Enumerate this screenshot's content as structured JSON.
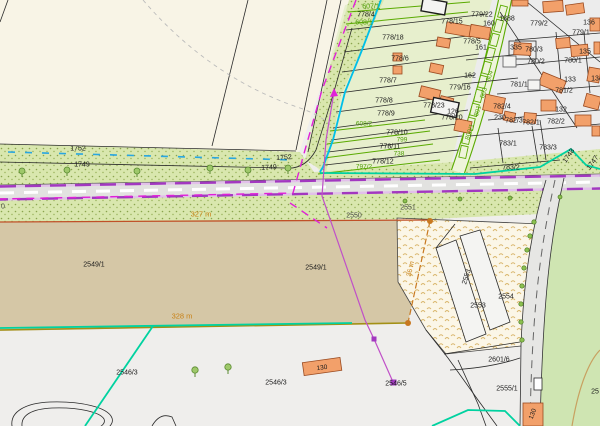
{
  "map": {
    "type": "cadastral-parcel-map",
    "label_colors": {
      "black": "#1b1b1b",
      "green": "#4f9e06",
      "orange": "#c88014",
      "gray": "#4a4a4a"
    },
    "feature_colors": {
      "selection_teal": "#00d2a0",
      "guide_cyan": "#00bfe8",
      "survey_magenta": "#e020d8",
      "road_axis_purple": "#a238c0",
      "dimension_orange": "#c87820",
      "field_tan": "#d5c7a6",
      "building_orange": "#f2a06a",
      "vegetation_green": "#d9e7ae",
      "water_dash_blue": "#2aa6e0"
    },
    "labels": [
      {
        "t": "1752",
        "x": 78,
        "y": 149
      },
      {
        "t": "1752",
        "x": 284,
        "y": 158,
        "r": -3
      },
      {
        "t": "1749",
        "x": 82,
        "y": 165
      },
      {
        "t": "1749",
        "x": 269,
        "y": 168,
        "r": -3
      },
      {
        "t": "607/1",
        "x": 371,
        "y": 7,
        "c": "green"
      },
      {
        "t": "778/4",
        "x": 366,
        "y": 15
      },
      {
        "t": "608/1",
        "x": 364,
        "y": 23,
        "c": "green"
      },
      {
        "t": "778/18",
        "x": 393,
        "y": 38
      },
      {
        "t": "778/6",
        "x": 400,
        "y": 59
      },
      {
        "t": "778/7",
        "x": 388,
        "y": 81
      },
      {
        "t": "778/8",
        "x": 384,
        "y": 101
      },
      {
        "t": "778/9",
        "x": 386,
        "y": 114
      },
      {
        "t": "608/2",
        "x": 364,
        "y": 124,
        "c": "green",
        "s": 6.5
      },
      {
        "t": "778/10",
        "x": 397,
        "y": 133
      },
      {
        "t": "799",
        "x": 402,
        "y": 140,
        "c": "green",
        "s": 6.5
      },
      {
        "t": "778/11",
        "x": 390,
        "y": 147
      },
      {
        "t": "738",
        "x": 399,
        "y": 154,
        "c": "green",
        "s": 6.5
      },
      {
        "t": "778/12",
        "x": 383,
        "y": 162
      },
      {
        "t": "797/2",
        "x": 364,
        "y": 167,
        "c": "green",
        "s": 6.5
      },
      {
        "t": "778/15",
        "x": 452,
        "y": 22
      },
      {
        "t": "779/22",
        "x": 482,
        "y": 15
      },
      {
        "t": "160",
        "x": 489,
        "y": 24
      },
      {
        "t": "1388",
        "x": 507,
        "y": 19
      },
      {
        "t": "779/2",
        "x": 539,
        "y": 24
      },
      {
        "t": "136",
        "x": 589,
        "y": 23
      },
      {
        "t": "779/1",
        "x": 581,
        "y": 33
      },
      {
        "t": "778/5",
        "x": 472,
        "y": 42
      },
      {
        "t": "161",
        "x": 481,
        "y": 48
      },
      {
        "t": "335",
        "x": 516,
        "y": 48
      },
      {
        "t": "780/3",
        "x": 534,
        "y": 50
      },
      {
        "t": "780/2",
        "x": 536,
        "y": 62
      },
      {
        "t": "135",
        "x": 585,
        "y": 52
      },
      {
        "t": "780/1",
        "x": 573,
        "y": 61
      },
      {
        "t": "162",
        "x": 470,
        "y": 76
      },
      {
        "t": "779/16",
        "x": 460,
        "y": 88
      },
      {
        "t": "781/1",
        "x": 519,
        "y": 85
      },
      {
        "t": "133",
        "x": 570,
        "y": 80
      },
      {
        "t": "134",
        "x": 597,
        "y": 79
      },
      {
        "t": "781/2",
        "x": 564,
        "y": 91
      },
      {
        "t": "778/23",
        "x": 434,
        "y": 106
      },
      {
        "t": "126",
        "x": 453,
        "y": 112
      },
      {
        "t": "778/20",
        "x": 452,
        "y": 118
      },
      {
        "t": "782/4",
        "x": 502,
        "y": 107
      },
      {
        "t": "230",
        "x": 500,
        "y": 118
      },
      {
        "t": "782/3",
        "x": 514,
        "y": 121
      },
      {
        "t": "782/1",
        "x": 531,
        "y": 123
      },
      {
        "t": "782/2",
        "x": 556,
        "y": 122
      },
      {
        "t": "132",
        "x": 561,
        "y": 110
      },
      {
        "t": "783/1",
        "x": 508,
        "y": 144
      },
      {
        "t": "783/3",
        "x": 548,
        "y": 148
      },
      {
        "t": "783/2",
        "x": 511,
        "y": 168
      },
      {
        "t": "1748",
        "x": 569,
        "y": 156,
        "r": -55
      },
      {
        "t": "1747",
        "x": 593,
        "y": 163,
        "r": -55
      },
      {
        "t": "804",
        "x": 490,
        "y": 76,
        "c": "green",
        "r": -72,
        "s": 6.5
      },
      {
        "t": "803",
        "x": 484,
        "y": 93,
        "c": "green",
        "r": -72,
        "s": 6.5
      },
      {
        "t": "801",
        "x": 478,
        "y": 111,
        "c": "green",
        "r": -72,
        "s": 6.5
      },
      {
        "t": "800/1",
        "x": 470,
        "y": 132,
        "c": "green",
        "r": -72,
        "s": 6.5
      },
      {
        "t": "2551",
        "x": 408,
        "y": 208,
        "c": "gray"
      },
      {
        "t": "2550",
        "x": 354,
        "y": 216,
        "c": "gray"
      },
      {
        "t": "0",
        "x": 3,
        "y": 207,
        "c": "gray"
      },
      {
        "t": "327 m",
        "x": 201,
        "y": 214,
        "c": "orange",
        "s": 7.5
      },
      {
        "t": "2549/1",
        "x": 94,
        "y": 265
      },
      {
        "t": "2549/1",
        "x": 316,
        "y": 268
      },
      {
        "t": "328 m",
        "x": 182,
        "y": 316,
        "c": "orange",
        "s": 7.5
      },
      {
        "t": "36 m",
        "x": 411,
        "y": 269,
        "c": "orange",
        "r": -78
      },
      {
        "t": "2546/3",
        "x": 127,
        "y": 373
      },
      {
        "t": "2546/3",
        "x": 276,
        "y": 383
      },
      {
        "t": "2546/5",
        "x": 396,
        "y": 384
      },
      {
        "t": "130",
        "x": 322,
        "y": 368,
        "r": -8,
        "s": 6.5
      },
      {
        "t": "2553",
        "x": 478,
        "y": 306
      },
      {
        "t": "2554",
        "x": 506,
        "y": 297
      },
      {
        "t": "2553",
        "x": 467,
        "y": 277,
        "r": -72
      },
      {
        "t": "2601/6",
        "x": 499,
        "y": 360
      },
      {
        "t": "2555/1",
        "x": 507,
        "y": 389
      },
      {
        "t": "130",
        "x": 533,
        "y": 414,
        "r": -70,
        "s": 6.5
      },
      {
        "t": "25",
        "x": 595,
        "y": 392
      }
    ]
  }
}
